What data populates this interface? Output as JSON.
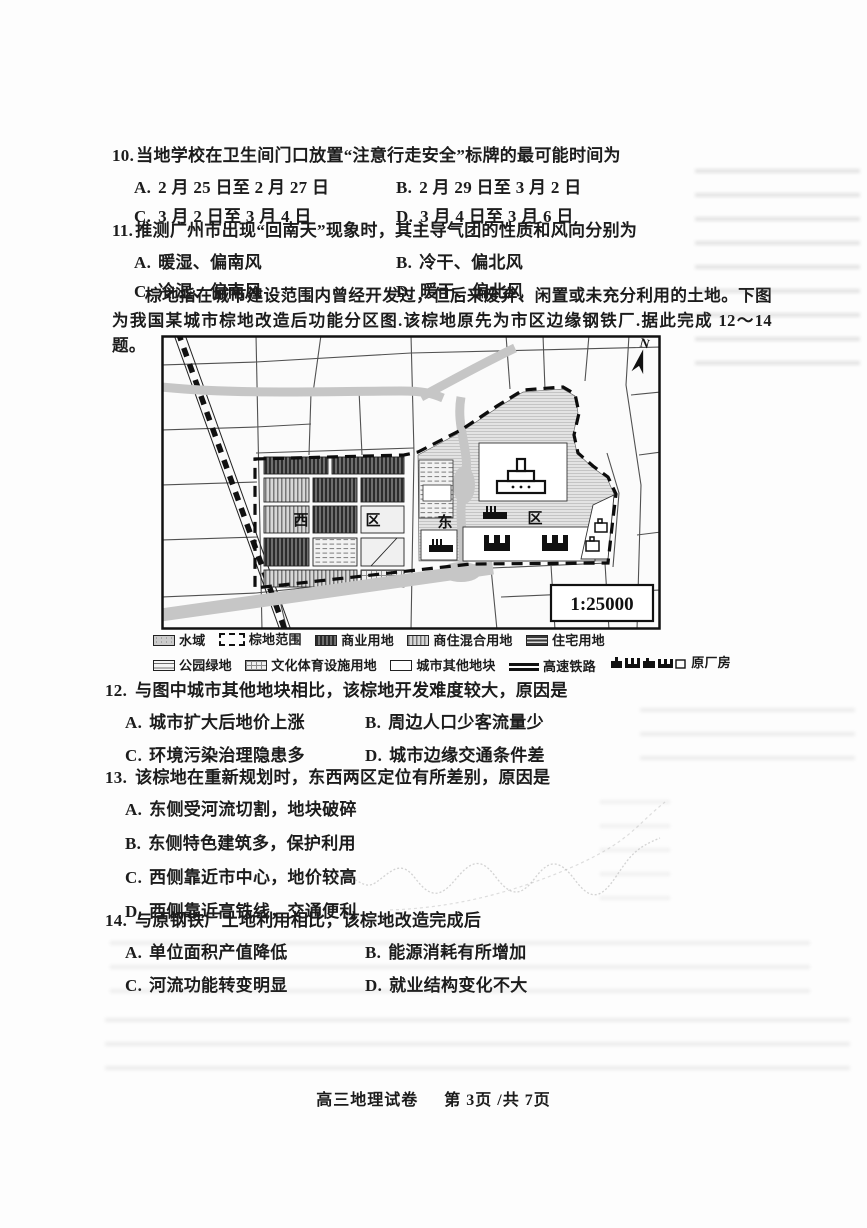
{
  "questions": [
    {
      "number": "10.",
      "stem": "当地学校在卫生间门口放置“注意行走安全”标牌的最可能时间为",
      "options": [
        {
          "label": "A.",
          "text": "2 月 25 日至 2 月 27 日"
        },
        {
          "label": "B.",
          "text": "2 月 29 日至 3 月 2 日"
        },
        {
          "label": "C.",
          "text": "3 月 2 日至 3 月 4 日"
        },
        {
          "label": "D.",
          "text": "3 月 4 日至 3 月 6 日"
        }
      ]
    },
    {
      "number": "11.",
      "stem": "推测广州市出现“回南天”现象时，其主导气团的性质和风向分别为",
      "options": [
        {
          "label": "A.",
          "text": "暖湿、偏南风"
        },
        {
          "label": "B.",
          "text": "冷干、偏北风"
        },
        {
          "label": "C.",
          "text": "冷湿、偏南风"
        },
        {
          "label": "D.",
          "text": "暖干、偏北风"
        }
      ]
    },
    {
      "number": "12.",
      "stem": "与图中城市其他地块相比，该棕地开发难度较大，原因是",
      "options": [
        {
          "label": "A.",
          "text": "城市扩大后地价上涨"
        },
        {
          "label": "B.",
          "text": "周边人口少客流量少"
        },
        {
          "label": "C.",
          "text": "环境污染治理隐患多"
        },
        {
          "label": "D.",
          "text": "城市边缘交通条件差"
        }
      ]
    },
    {
      "number": "13.",
      "stem": "该棕地在重新规划时，东西两区定位有所差别，原因是",
      "options": [
        {
          "label": "A.",
          "text": "东侧受河流切割，地块破碎"
        },
        {
          "label": "B.",
          "text": "东侧特色建筑多，保护利用"
        },
        {
          "label": "C.",
          "text": "西侧靠近市中心，地价较高"
        },
        {
          "label": "D.",
          "text": "西侧靠近高铁线，交通便利"
        }
      ]
    },
    {
      "number": "14.",
      "stem": "与原钢铁厂土地利用相比，该棕地改造完成后",
      "options": [
        {
          "label": "A.",
          "text": "单位面积产值降低"
        },
        {
          "label": "B.",
          "text": "能源消耗有所增加"
        },
        {
          "label": "C.",
          "text": "河流功能转变明显"
        },
        {
          "label": "D.",
          "text": "就业结构变化不大"
        }
      ]
    }
  ],
  "passage": "棕地指在城市建设范围内曾经开发过，但后来废弃、闲置或未充分利用的土地。下图为我国某城市棕地改造后功能分区图.该棕地原先为市区边缘钢铁厂.据此完成 12～14 题。",
  "map": {
    "scale": "1:25000",
    "north": "N",
    "labels": {
      "west1": "西",
      "west2": "区",
      "east1": "东",
      "east2": "区"
    }
  },
  "legend": {
    "row1": [
      {
        "key": "water",
        "label": "水域"
      },
      {
        "key": "brownfield",
        "label": "棕地范围"
      },
      {
        "key": "commercial",
        "label": "商业用地"
      },
      {
        "key": "mixed",
        "label": "商住混合用地"
      },
      {
        "key": "residential",
        "label": "住宅用地"
      }
    ],
    "row2": [
      {
        "key": "park",
        "label": "公园绿地"
      },
      {
        "key": "culture",
        "label": "文化体育设施用地"
      },
      {
        "key": "other",
        "label": "城市其他地块"
      },
      {
        "key": "rail",
        "label": "高速铁路"
      },
      {
        "key": "factory",
        "label": "原厂房"
      }
    ]
  },
  "footer": {
    "title": "高三地理试卷",
    "page": "第 3页 /共 7页"
  }
}
